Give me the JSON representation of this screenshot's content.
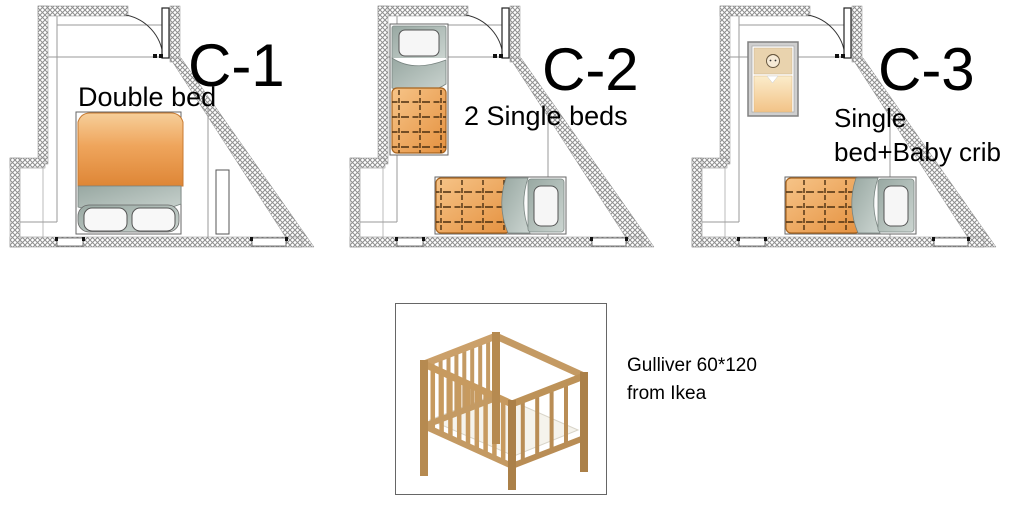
{
  "panels": [
    {
      "label": "C-1",
      "caption_line1": "Double bed",
      "caption_line2": ""
    },
    {
      "label": "C-2",
      "caption_line1": "2 Single beds",
      "caption_line2": ""
    },
    {
      "label": "C-3",
      "caption_line1": "Single",
      "caption_line2": "bed+Baby crib"
    }
  ],
  "product": {
    "line1": "Gulliver 60*120",
    "line2": "from Ikea"
  },
  "colors": {
    "duvet_orange": "#e8953f",
    "blanket_gray": "#a9b6b1",
    "crib_wood": "#c49a63",
    "wall_hatch": "#8f8f8f",
    "text": "#000000"
  }
}
